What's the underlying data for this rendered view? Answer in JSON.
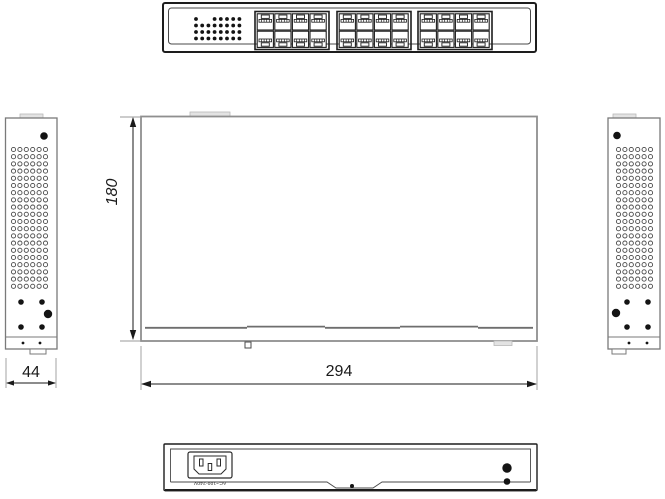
{
  "drawing": {
    "type": "mechanical-dimension-drawing",
    "subject": "24-port-network-switch"
  },
  "dimensions": {
    "depth_label": "180",
    "width_label": "294",
    "side_width_label": "44"
  },
  "rear_panel": {
    "power_rating_label": "AC~100-240V"
  },
  "front_panel": {
    "port_groups": 3,
    "ports_per_row": 4,
    "port_rows": 2,
    "total_ports": 24,
    "led_pattern": [
      [
        1,
        0,
        0,
        1,
        1,
        1,
        1,
        1
      ],
      [
        1,
        1,
        1,
        1,
        1,
        1,
        1,
        1
      ],
      [
        1,
        1,
        1,
        1,
        1,
        1,
        1,
        1
      ],
      [
        1,
        1,
        1,
        1,
        1,
        1,
        1,
        1
      ]
    ]
  },
  "side_panels": {
    "vent_rows": 20,
    "vent_cols": 6
  },
  "colors": {
    "line_dark": "#1d1d1d",
    "line_gray": "#8f8f8f",
    "dot_fill": "#141414"
  }
}
